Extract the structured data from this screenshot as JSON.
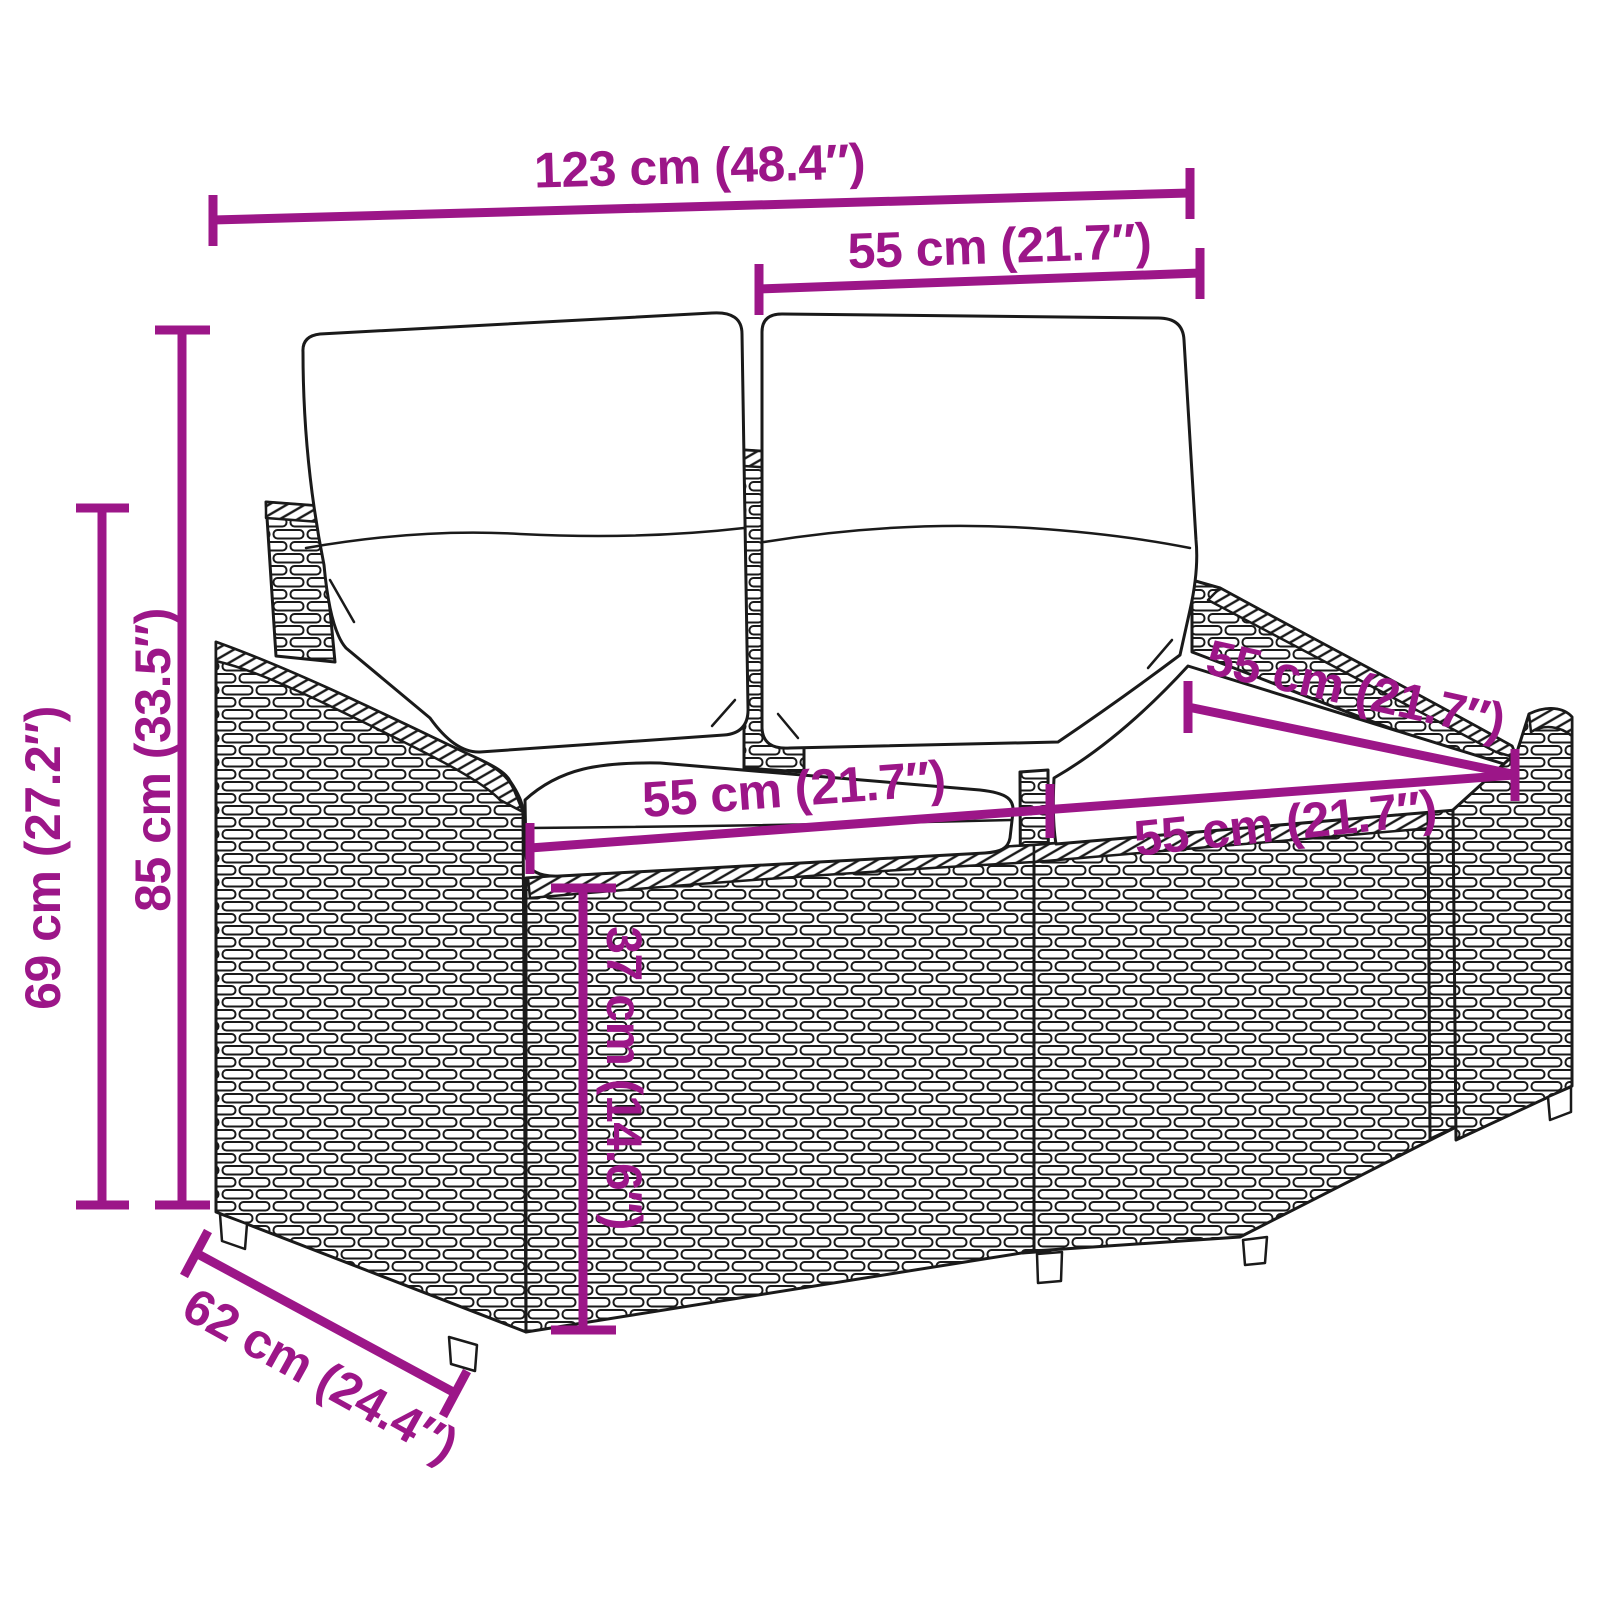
{
  "page": {
    "background_color": "#ffffff"
  },
  "diagram": {
    "accent_color": "#9c1688",
    "outline_color": "#1a1a1a",
    "dimensions": {
      "overall_width": {
        "label": "123 cm (48.4″)"
      },
      "back_cushion_width": {
        "label": "55 cm (21.7″)"
      },
      "total_height": {
        "label": "85 cm (33.5″)"
      },
      "armrest_height": {
        "label": "69 cm (27.2″)"
      },
      "seat_width_left": {
        "label": "55 cm (21.7″)"
      },
      "seat_width_right": {
        "label": "55 cm (21.7″)"
      },
      "seat_depth": {
        "label": "55 cm (21.7″)"
      },
      "seat_height": {
        "label": "37 cm (14.6″)"
      },
      "base_depth": {
        "label": "62 cm (24.4″)"
      }
    }
  }
}
